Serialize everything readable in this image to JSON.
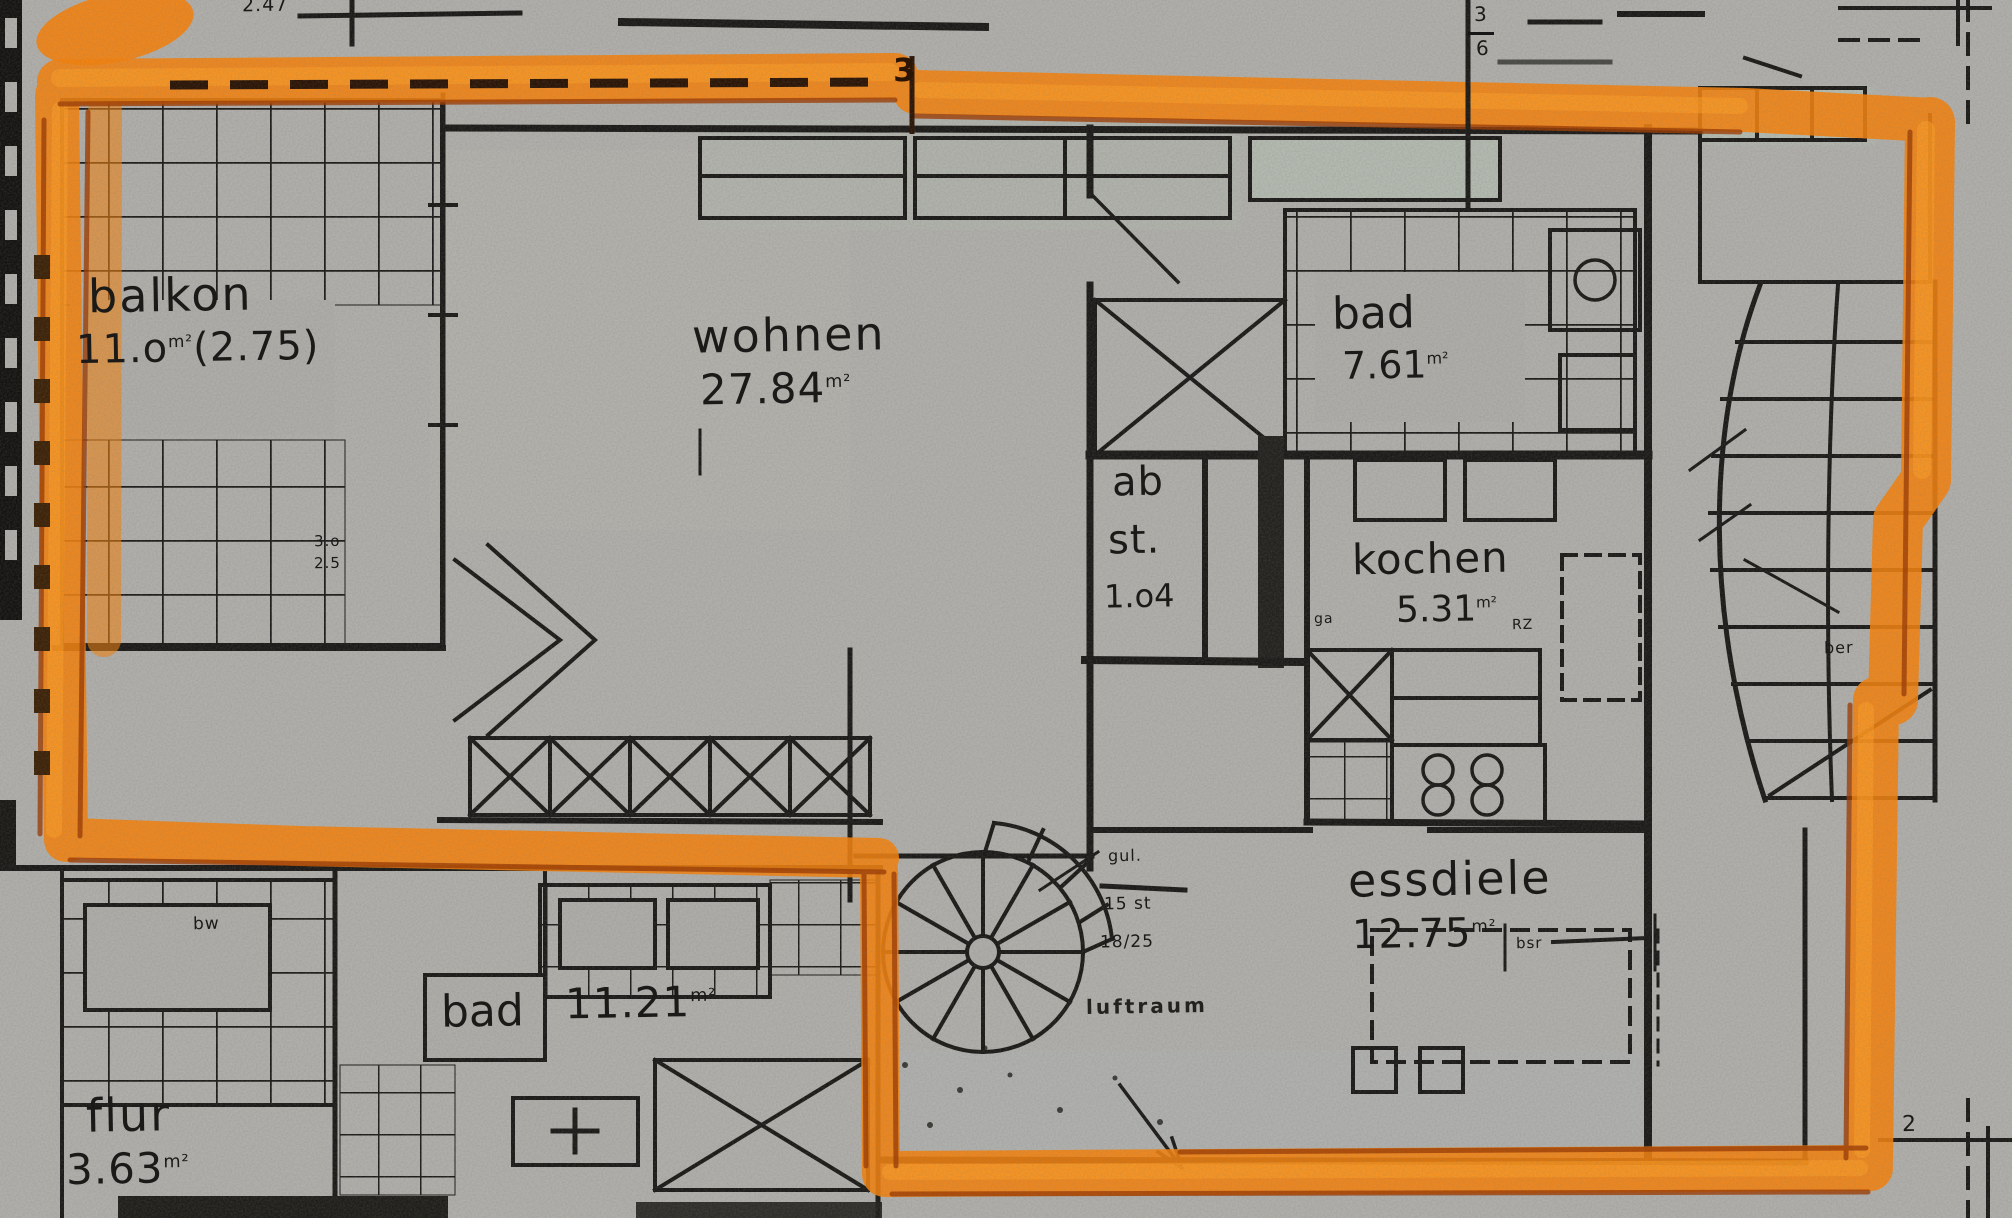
{
  "document": {
    "kind": "highlighted floor plan scan",
    "highlight_color": "#f5820d",
    "paper_color": "#b0afab",
    "ink_color": "#1b1a18"
  },
  "units": {
    "sqm": "m²"
  },
  "rooms": {
    "balkon": {
      "name": "balkon",
      "area_a": "11.o",
      "area_b": "(2.75)"
    },
    "wohnen": {
      "name": "wohnen",
      "area": "27.84"
    },
    "bad_top": {
      "name": "bad",
      "area": "7.61"
    },
    "abst": {
      "line1": "ab",
      "line2": "st.",
      "area": "1.o4"
    },
    "kochen": {
      "name": "kochen",
      "area": "5.31"
    },
    "essdiele": {
      "name": "essdiele",
      "area": "12.75"
    },
    "bad_bottom": {
      "name": "bad",
      "area": "11.21"
    },
    "flur": {
      "name": "flur",
      "area": "3.63"
    }
  },
  "stair": {
    "note1": "gul.",
    "note2": "15 st",
    "note3": "18/25",
    "void_label": "luftraum"
  },
  "annotations": {
    "top_left_dim": "2.47",
    "top_marker": "3",
    "fraction_top": "3",
    "fraction_bottom": "6",
    "balkon_dim1": "3.o",
    "balkon_dim2": "2.5",
    "bw": "bw",
    "bsr": "bsr",
    "ber": "ber",
    "ga": "ga",
    "rz": "RZ",
    "corner_num": "2"
  }
}
